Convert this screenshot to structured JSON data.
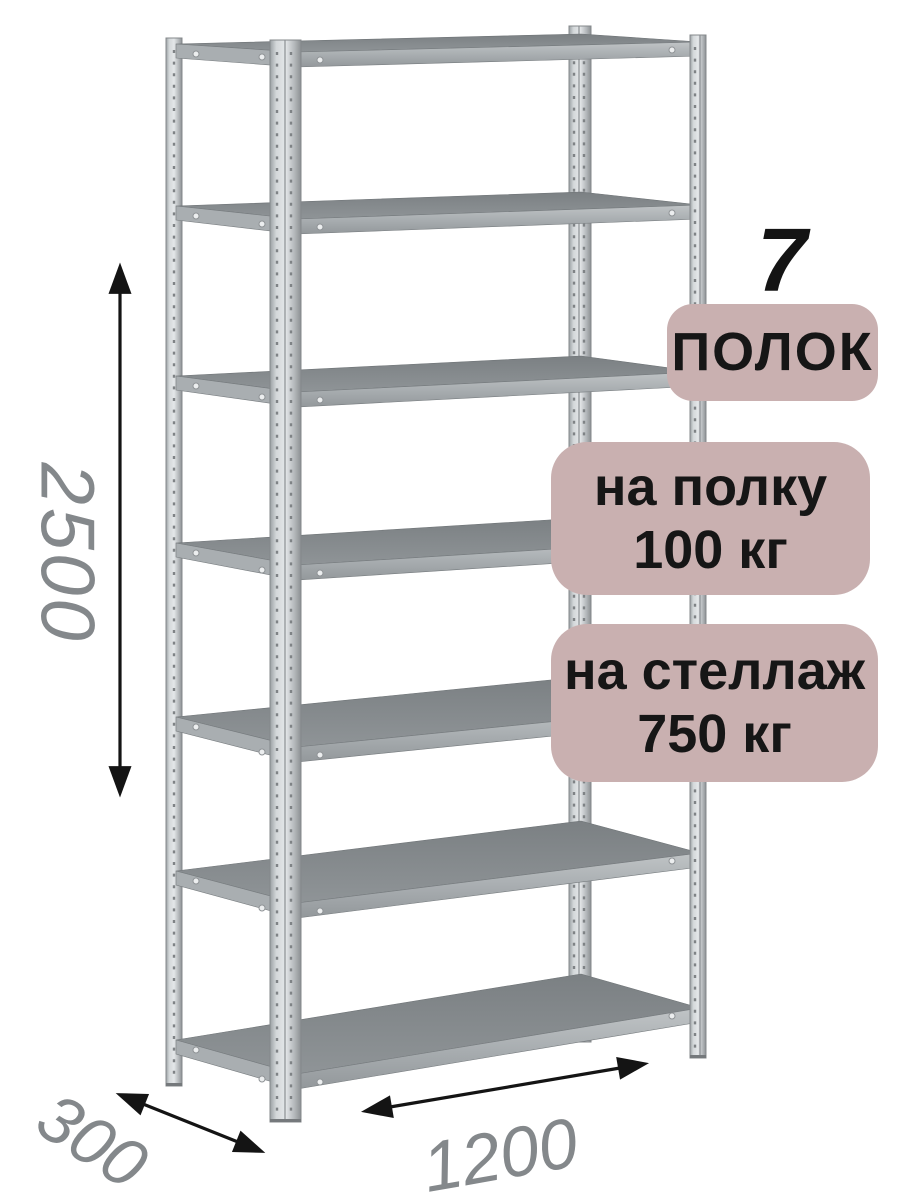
{
  "page": {
    "background": "#ffffff"
  },
  "illustration": {
    "name": "metal-shelving-rack-seven-shelves",
    "shelf_rows": 7
  },
  "callouts": {
    "count_number": "7",
    "count_label": "ПОЛОК",
    "per_shelf": {
      "line1": "на полку",
      "line2": "100 кг"
    },
    "per_rack": {
      "line1": "на стеллаж",
      "line2": "750 кг"
    }
  },
  "dimensions": {
    "height_mm": "2500",
    "depth_mm": "300",
    "width_mm": "1200"
  },
  "colors": {
    "page_bg": "#ffffff",
    "badge_bg": "#c9b0b0",
    "badge_text": "#161616",
    "count_text": "#141414",
    "dimension_line": "#141414",
    "dimension_text": "#84888b",
    "metal_light": "#e4e7e9",
    "metal_mid": "#a9aeb1",
    "shelf_surface": "#85898c"
  }
}
